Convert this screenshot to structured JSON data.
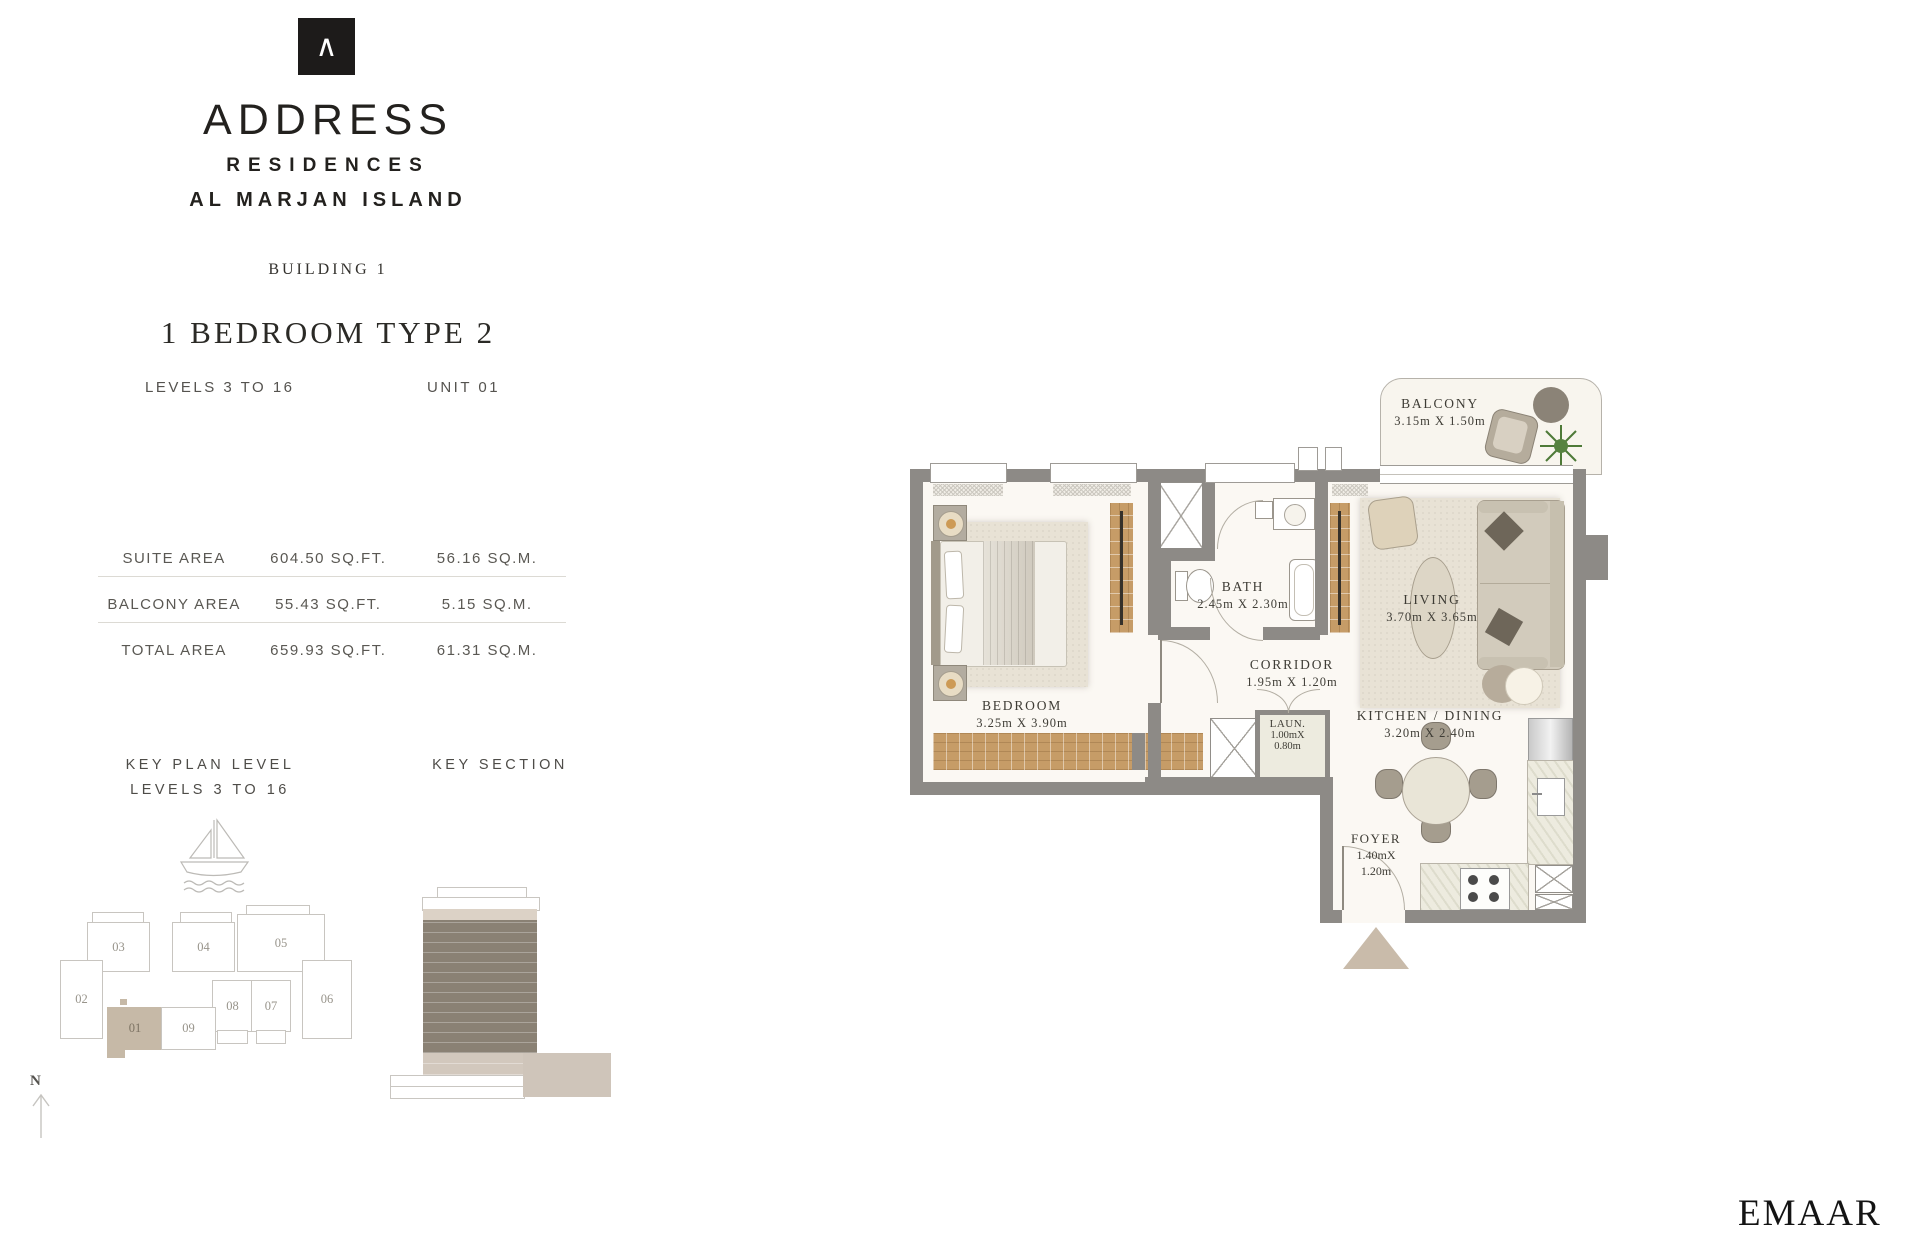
{
  "brand": {
    "logo_symbol": "∧",
    "name": "ADDRESS",
    "sub1": "RESIDENCES",
    "sub2": "AL MARJAN ISLAND"
  },
  "header": {
    "building": "BUILDING 1",
    "unit_type": "1 BEDROOM TYPE 2",
    "levels": "LEVELS 3 TO 16",
    "unit": "UNIT 01"
  },
  "area_table": {
    "rows": [
      {
        "label": "SUITE AREA",
        "sqft": "604.50 SQ.FT.",
        "sqm": "56.16 SQ.M."
      },
      {
        "label": "BALCONY AREA",
        "sqft": "55.43 SQ.FT.",
        "sqm": "5.15 SQ.M."
      },
      {
        "label": "TOTAL AREA",
        "sqft": "659.93 SQ.FT.",
        "sqm": "61.31 SQ.M."
      }
    ]
  },
  "key_plan": {
    "title1": "KEY PLAN LEVEL",
    "title2": "LEVELS 3 TO 16",
    "highlighted_unit": "01",
    "units": [
      {
        "id": "03"
      },
      {
        "id": "04"
      },
      {
        "id": "05"
      },
      {
        "id": "02"
      },
      {
        "id": "08"
      },
      {
        "id": "07"
      },
      {
        "id": "06"
      },
      {
        "id": "01"
      },
      {
        "id": "09"
      }
    ]
  },
  "key_section": {
    "title": "KEY SECTION"
  },
  "compass": {
    "label": "N"
  },
  "floor_plan": {
    "rooms": {
      "balcony": {
        "name": "BALCONY",
        "dims": "3.15m X 1.50m"
      },
      "bedroom": {
        "name": "BEDROOM",
        "dims": "3.25m X 3.90m"
      },
      "bath": {
        "name": "BATH",
        "dims": "2.45m X 2.30m"
      },
      "corridor": {
        "name": "CORRIDOR",
        "dims": "1.95m X 1.20m"
      },
      "laundry": {
        "name": "LAUN.",
        "w": "1.00mX",
        "h": "0.80m"
      },
      "living": {
        "name": "LIVING",
        "dims": "3.70m X 3.65m"
      },
      "kitchen": {
        "name": "KITCHEN / DINING",
        "dims": "3.20m X 2.40m"
      },
      "foyer": {
        "name": "FOYER",
        "w": "1.40mX",
        "h": "1.20m"
      }
    }
  },
  "footer": {
    "brand": "EMAAR"
  },
  "colors": {
    "ink": "#1d1b1a",
    "accent_tan": "#c6b9a7",
    "wall_gray": "#8d8a86",
    "wood": "#c69c67",
    "section_dark": "#8a8174"
  }
}
